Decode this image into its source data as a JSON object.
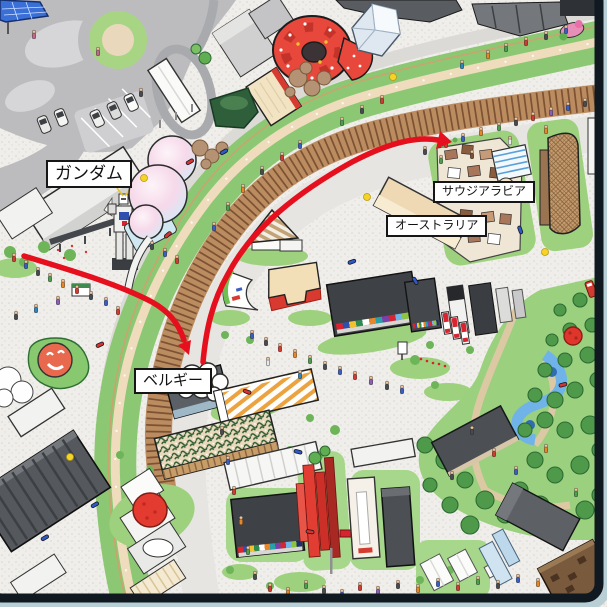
{
  "map": {
    "kind": "illustrated-expo-site-map",
    "labels": [
      {
        "id": "gundam",
        "text": "ガンダム"
      },
      {
        "id": "saudi-arabia",
        "text": "サウジアラビア"
      },
      {
        "id": "australia",
        "text": "オーストラリア"
      },
      {
        "id": "belgium",
        "text": "ベルギー"
      }
    ],
    "route": {
      "color": "#e60f1e",
      "segments": [
        {
          "from": "west-plaza",
          "to": "belgium-pavilion",
          "arrow": true
        },
        {
          "from": "belgium-pavilion",
          "to": "saudi-arabia-pavilion",
          "arrow": true
        }
      ]
    },
    "palette": {
      "ground": "#f0eeea",
      "road": "#bcbcbf",
      "ring_green": "#8cc873",
      "ring_path": "#eedcbd",
      "ring_wall": "#bb8c60",
      "forest": "#9bd07f",
      "water": "#6fb3e8",
      "accent_red": "#e03a30"
    }
  },
  "frame": {
    "inner_color": "#101820",
    "outer_color": "#b9cfd6"
  }
}
